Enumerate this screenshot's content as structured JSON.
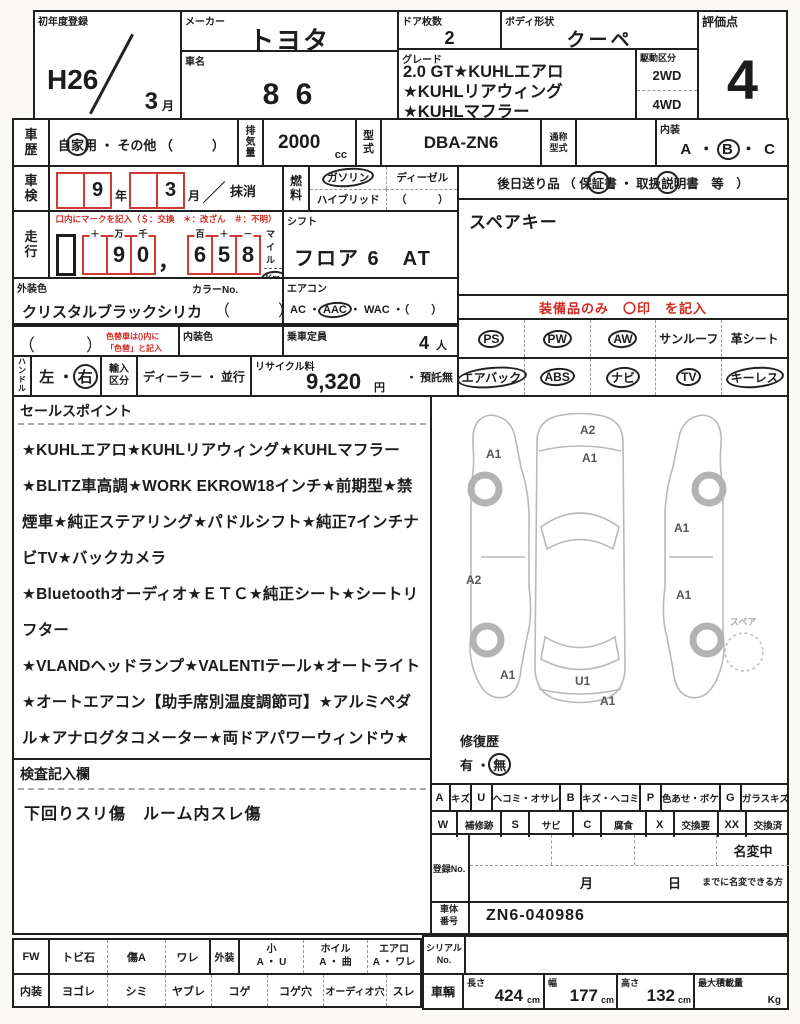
{
  "row1": {
    "first_reg_label": "初年度登録",
    "first_reg_year": "H26",
    "first_reg_month": "3",
    "first_reg_month_unit": "月",
    "maker_label": "メーカー",
    "maker_value": "トヨタ",
    "car_name_label": "車名",
    "car_name_value": "8 6",
    "doors_label": "ドア枚数",
    "doors_value": "2",
    "body_label": "ボディ形状",
    "body_value": "クーペ",
    "grade_label": "グレード",
    "grade_line1": "2.0 GT★KUHLエアロ",
    "grade_line2": "★KUHLリアウィング",
    "grade_line3": "★KUHLマフラー",
    "drive_label": "駆動区分",
    "drive_2wd": "2WD",
    "drive_4wd": "4WD",
    "score_label": "評価点",
    "score_value": "4"
  },
  "row2": {
    "history_label": "車歴",
    "history_a": "自",
    "history_b": "家",
    "history_c": "用",
    "history_dot": "・",
    "history_other": "その他 （　　　）",
    "disp_label": "排気量",
    "disp_value": "2000",
    "disp_unit": "cc",
    "model_label": "型式",
    "model_value": "DBA-ZN6",
    "alias_label": "通称型式",
    "interior_label": "内装",
    "interior_a": "A",
    "interior_dot1": "・",
    "interior_b": "B",
    "interior_dot2": "・",
    "interior_c": "C"
  },
  "row3": {
    "shaken_label": "車検",
    "shaken_year": "9",
    "shaken_year_unit": "年",
    "shaken_month": "3",
    "shaken_month_unit": "月",
    "shaken_slash": "／",
    "shaken_erase": "抹消",
    "fuel_label": "燃料",
    "fuel_gas": "ガソリン",
    "fuel_diesel": "ディーゼル",
    "fuel_hybrid": "ハイブリッド",
    "fuel_other": "（　　　）",
    "later_pre": "後日送り品 （ 保",
    "later_c1": "証",
    "later_mid": "書 ・ 取扱",
    "later_c2": "説",
    "later_post": "明書　等　）"
  },
  "row4": {
    "soko_label": "走行",
    "soko_note": "口内にマークを記入（＄：交換　＊：改ざん　＃：不明）",
    "g1l1": "＋",
    "g1l2": "万",
    "g1l3": "千",
    "g1d1": "",
    "g1d2": "9",
    "g1d3": "0",
    "comma": "，",
    "g2l1": "百",
    "g2l2": "＋",
    "g2l3": "－",
    "g2d1": "6",
    "g2d2": "5",
    "g2d3": "8",
    "mile": "マイル",
    "km": "Km",
    "shift_label": "シフト",
    "shift_value": "フロア 6　AT",
    "spare_key": "スペアキー"
  },
  "row5": {
    "ext_label": "外装色",
    "ext_value": "クリスタルブラックシリカ",
    "color_no_label": "カラーNo.",
    "color_no_paren": "（　　　）",
    "ac_label": "エアコン",
    "ac_pre": "AC ・",
    "ac_circ": "AAC",
    "ac_post": "・ WAC ・（　　）"
  },
  "row6": {
    "repaint_paren": "（　　　）",
    "repaint_note1": "色替車は()内に",
    "repaint_note2": "「色替」と記入",
    "int_color_label": "内装色",
    "capacity_label": "乗車定員",
    "capacity_value": "4",
    "capacity_unit": "人"
  },
  "row7": {
    "handle_label": "ハンドル",
    "handle_left": "左",
    "handle_dot": "・",
    "handle_right": "右",
    "import_label": "輸入区分",
    "import_dealer": "ディーラー",
    "import_dot": "・",
    "import_parallel": "並行",
    "recycle_label": "リサイクル料",
    "recycle_value": "9,320",
    "recycle_unit": "円",
    "recycle_deposit": "・ 預託無"
  },
  "equipment": {
    "header": "装備品のみ　〇印　を記入",
    "r1c1": "PS",
    "r1c2": "PW",
    "r1c3": "AW",
    "r1c4": "サンルーフ",
    "r1c5": "革シート",
    "r2c1": "エアバック",
    "r2c2": "ABS",
    "r2c3": "ナビ",
    "r2c4": "TV",
    "r2c5": "キーレス",
    "circled": {
      "r1c1": true,
      "r1c2": true,
      "r1c3": true,
      "r1c4": false,
      "r1c5": false,
      "r2c1": true,
      "r2c2": true,
      "r2c3": true,
      "r2c4": true,
      "r2c5": true
    }
  },
  "sales": {
    "title": "セールスポイント",
    "text": "★KUHLエアロ★KUHLリアウィング★KUHLマフラー★BLITZ車高調★WORK EKROW18インチ★前期型★禁煙車★純正ステアリング★パドルシフト★純正7インチナビTV★バックカメラ\n★Bluetoothオーディオ★ＥＴＣ★純正シート★シートリフター\n★VLANDヘッドランプ★VALENTIテール★オートライト★オートエアコン【助手席別温度調節可】★アルミペダル★アナログタコメーター★両ドアパワーウィンドウ★電動ミラー★パワーステアリング★運転席エアバック★助手席エアバック★サイドエアバック★カーテンエアバック★衝撃緩和ヘッドレスト\n★ABS★TRC★LSD★盗難防止装置★UVカットガラス★プライバシーガラス★ISOFIX対応チャイルドシート固定専用バー★スマートキー2コ★スマートエントリー★プッシュスタート★"
  },
  "inspection": {
    "title": "検査記入欄",
    "text": "下回りスリ傷　ルーム内スレ傷"
  },
  "diagram": {
    "spare_label": "スペア",
    "marks": [
      {
        "t": "A2",
        "x": 148,
        "y": 26
      },
      {
        "t": "A1",
        "x": 54,
        "y": 50
      },
      {
        "t": "A1",
        "x": 150,
        "y": 54
      },
      {
        "t": "A1",
        "x": 242,
        "y": 124
      },
      {
        "t": "A2",
        "x": 34,
        "y": 176
      },
      {
        "t": "A1",
        "x": 244,
        "y": 191
      },
      {
        "t": "A1",
        "x": 68,
        "y": 271
      },
      {
        "t": "U1",
        "x": 143,
        "y": 277
      },
      {
        "t": "A1",
        "x": 168,
        "y": 297
      }
    ]
  },
  "repair": {
    "label": "修復歴",
    "yes": "有",
    "dot": "・",
    "no": "無"
  },
  "legend": {
    "r1": [
      {
        "k": "A",
        "v": "キズ"
      },
      {
        "k": "U",
        "v": "ヘコミ・オサレ"
      },
      {
        "k": "B",
        "v": "キズ・ヘコミ"
      },
      {
        "k": "P",
        "v": "色あせ・ボケ"
      },
      {
        "k": "G",
        "v": "ガラスキズ"
      }
    ],
    "r2": [
      {
        "k": "W",
        "v": "補修跡"
      },
      {
        "k": "S",
        "v": "サビ"
      },
      {
        "k": "C",
        "v": "腐食"
      },
      {
        "k": "X",
        "v": "交換要"
      },
      {
        "k": "XX",
        "v": "交換済"
      }
    ]
  },
  "registration": {
    "band": "登録No.",
    "meihen": "名変中",
    "month": "月",
    "day": "日",
    "note": "までに名変できる方"
  },
  "vin": {
    "band": "車体番号",
    "value": "ZN6-040986"
  },
  "bottom": {
    "r1_band": "FW",
    "r1c1": "トビ石",
    "r1c2": "傷A",
    "r1c3": "ワレ",
    "r1_band2": "外装",
    "r1g1h": "小",
    "r1g1v": "A ・ U",
    "r1g2h": "ホイル",
    "r1g2v": "A ・ 曲",
    "r1g3h": "エアロ",
    "r1g3v": "A ・ ワレ",
    "r2_band": "内装",
    "r2c1": "ヨゴレ",
    "r2c2": "シミ",
    "r2c3": "ヤブレ",
    "r2c4": "コゲ",
    "r2c5": "コゲ穴",
    "r2c6": "オーディオ穴",
    "r2c7": "スレ",
    "serial_band": "シリアルNo.",
    "veh_band": "車輌",
    "len_label": "長さ",
    "len_value": "424",
    "wid_label": "幅",
    "wid_value": "177",
    "hei_label": "高さ",
    "hei_value": "132",
    "cm": "cm",
    "payload_label": "最大積載量",
    "payload_unit": "Kg"
  }
}
